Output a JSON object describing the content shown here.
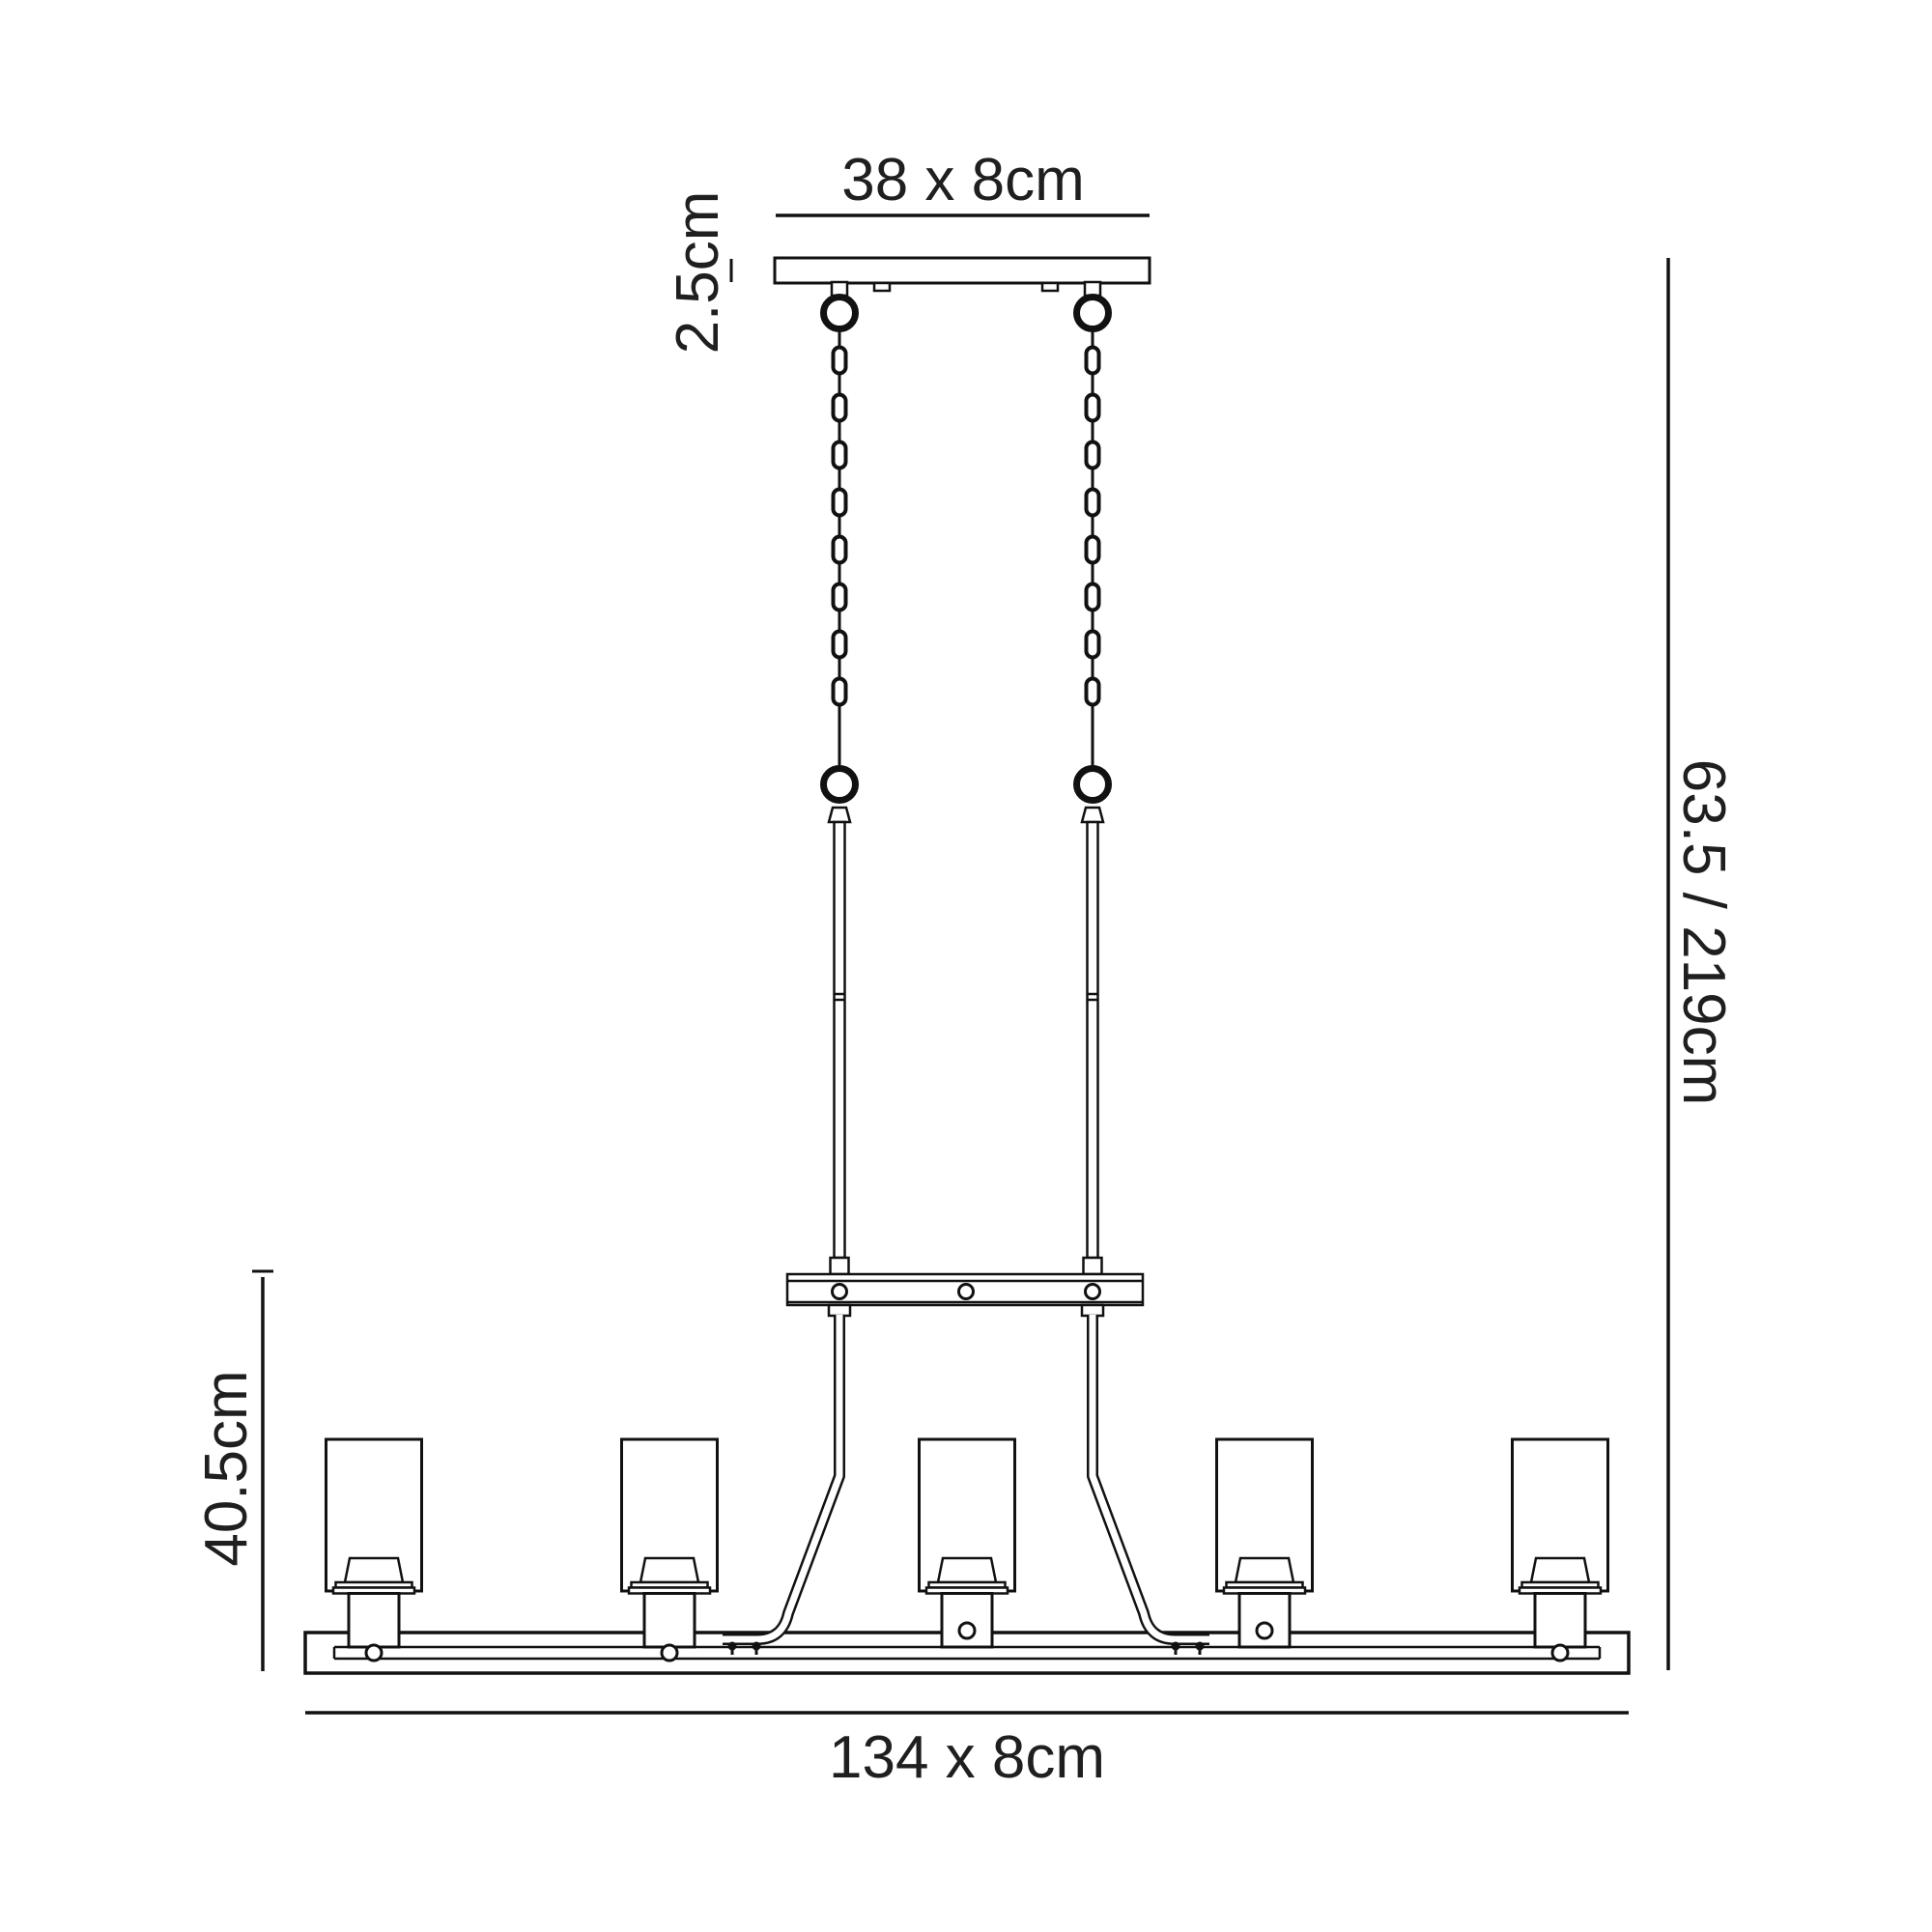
{
  "diagram": {
    "colors": {
      "line": "#111111",
      "text": "#1f1f1f",
      "background": "#ffffff"
    },
    "labels": {
      "canopy_size": "38 x 8cm",
      "canopy_height": "2.5cm",
      "overall_height": "63.5 / 219cm",
      "body_height": "40.5cm",
      "bar_size": "134 x 8cm"
    },
    "fixture": {
      "shade_count": 5,
      "chain_count": 2,
      "chain_links_per_chain": 8,
      "crossbar_screw_count": 3
    }
  }
}
